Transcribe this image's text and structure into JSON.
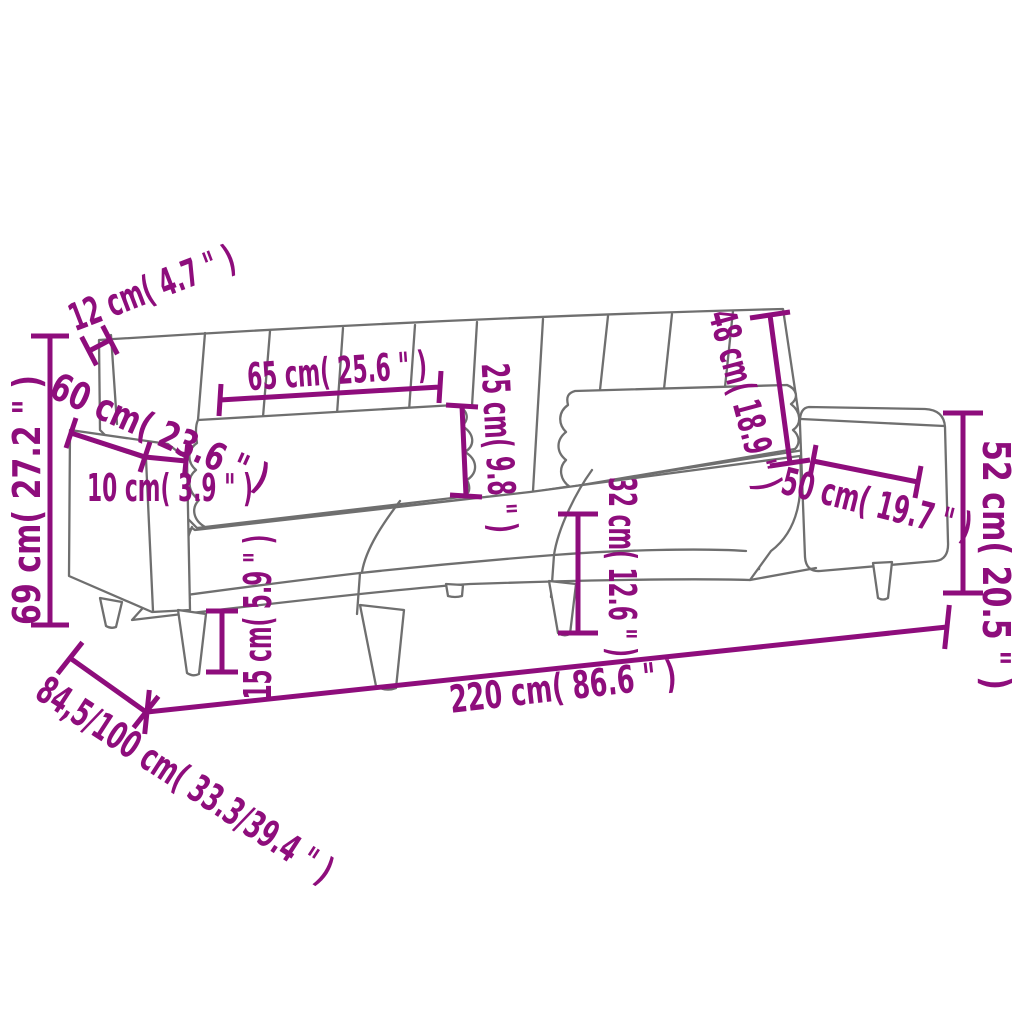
{
  "diagram": {
    "title": "Sofa bed dimension drawing",
    "colors": {
      "dimension": "#8E0D7C",
      "outline": "#6F6F6F",
      "background": "#FFFFFF"
    },
    "dims": {
      "d12": {
        "label": "12 cm( 4.7 \" )"
      },
      "d60": {
        "label": "60 cm( 23.6 \" )"
      },
      "d69": {
        "label": "69 cm( 27.2 \" )"
      },
      "d10": {
        "label": "10 cm( 3.9 \" )"
      },
      "d65": {
        "label": "65 cm( 25.6 \" )"
      },
      "d25": {
        "label": "25 cm( 9.8 \" )"
      },
      "d48": {
        "label": "48 cm( 18.9 \" )"
      },
      "d52": {
        "label": "52 cm( 20.5 \" )"
      },
      "d50": {
        "label": "50 cm( 19.7 \" )"
      },
      "d32": {
        "label": "32 cm( 12.6 \" )"
      },
      "d15": {
        "label": "15 cm( 5.9 \" )"
      },
      "d220": {
        "label": "220 cm( 86.6 \" )"
      },
      "d84": {
        "label": "84,5/100 cm( 33.3/39.4 \" )"
      }
    }
  }
}
